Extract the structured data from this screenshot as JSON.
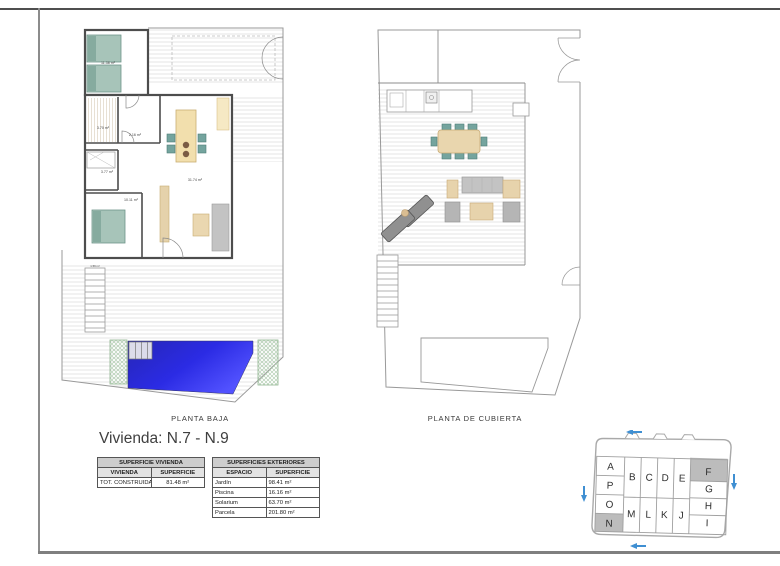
{
  "sheet": {
    "title": "Vivienda: N.7 - N.9"
  },
  "plans": {
    "planta_baja": {
      "caption": "PLANTA BAJA",
      "room_labels": {
        "bedroom1": "11.38 m²",
        "bath1": "3.70 m²",
        "hall": "2.16 m²",
        "bath2": "3.77 m²",
        "bedroom2": "10.11 m²",
        "living": "31.74 m²",
        "store": "1.59 m²"
      }
    },
    "planta_cubierta": {
      "caption": "PLANTA DE CUBIERTA"
    }
  },
  "tables": {
    "superficie_vivienda": {
      "title": "SUPERFICIE VIVIENDA",
      "columns": [
        "VIVIENDA",
        "SUPERFICIE"
      ],
      "rows": [
        {
          "label": "TOT. CONSTRUIDA",
          "value": "81.48 m²"
        }
      ]
    },
    "superficies_exteriores": {
      "title": "SUPERFICIES EXTERIORES",
      "columns": [
        "ESPACIO",
        "SUPERFICIE"
      ],
      "rows": [
        {
          "label": "Jardín",
          "value": "98.41 m²"
        },
        {
          "label": "Piscina",
          "value": "16.16 m²"
        },
        {
          "label": "Solarium",
          "value": "63.70 m²"
        },
        {
          "label": "Parcela",
          "value": "201.80 m²"
        }
      ]
    }
  },
  "site_key": {
    "cells": [
      "A",
      "P",
      "O",
      "N",
      "B",
      "C",
      "D",
      "E",
      "M",
      "L",
      "K",
      "J",
      "F",
      "G",
      "H",
      "I"
    ],
    "highlighted": [
      "N",
      "F"
    ],
    "highlight_color": "#bcbcbc",
    "arrow_color": "#3f8fd2"
  },
  "colors": {
    "pool_dark": "#2626b6",
    "pool_bright": "#5252ff",
    "furniture_teal": "#a7c4b9",
    "furniture_tan": "#eeddb2"
  }
}
